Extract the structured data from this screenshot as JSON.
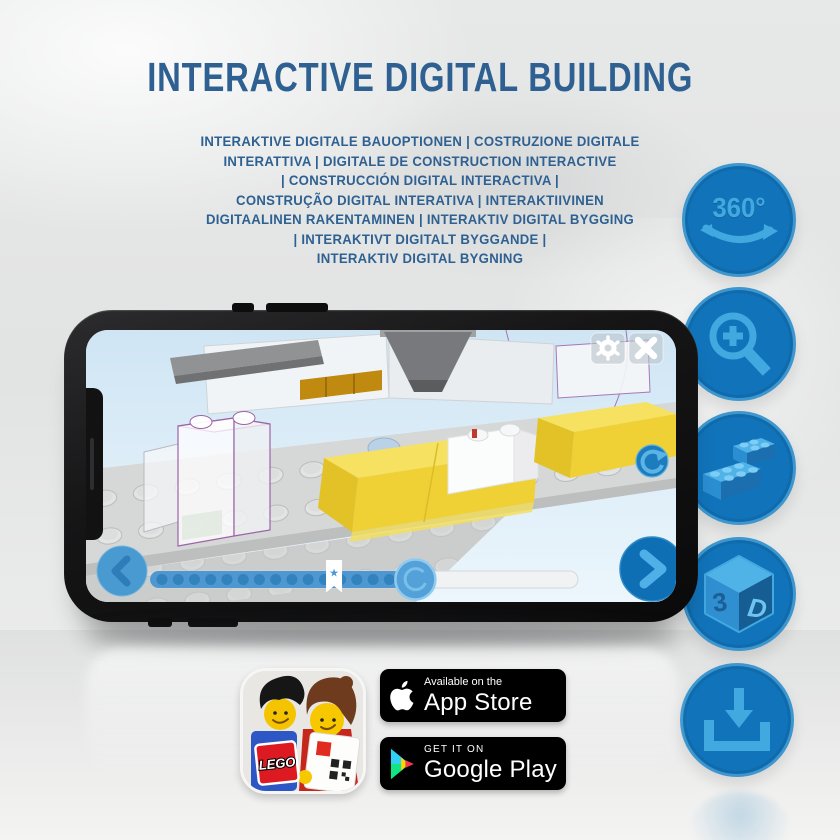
{
  "header": {
    "title": "INTERACTIVE DIGITAL BUILDING",
    "subtitle_lines": [
      "INTERAKTIVE DIGITALE BAUOPTIONEN | COSTRUZIONE DIGITALE",
      "INTERATTIVA | DIGITALE DE CONSTRUCTION INTERACTIVE",
      "| CONSTRUCCIÓN DIGITAL INTERACTIVA |",
      "CONSTRUÇÃO DIGITAL INTERATIVA | INTERAKTIIVINEN",
      "DIGITAALINEN RAKENTAMINEN | INTERAKTIV DIGITAL BYGGING",
      "| INTERAKTIVT DIGITALT BYGGANDE |",
      "INTERAKTIV DIGITAL BYGNING"
    ]
  },
  "feature_badges": [
    {
      "id": "rotate-360",
      "label": "360°"
    },
    {
      "id": "zoom-in"
    },
    {
      "id": "brick-building"
    },
    {
      "id": "3d-view",
      "face_left": "3",
      "face_right": "D"
    },
    {
      "id": "download"
    }
  ],
  "phone": {
    "progress": {
      "dot_count": 15,
      "star_position": 0.43,
      "handle_position": 0.62,
      "star_glyph": "★"
    }
  },
  "store": {
    "app_name": "LEGO",
    "app_store": {
      "tagline": "Available on the",
      "name": "App Store"
    },
    "google_play": {
      "tagline": "GET IT ON",
      "name": "Google Play"
    }
  },
  "colors": {
    "title_blue": "#2e6191",
    "badge_blue": "#1173b9",
    "badge_icon_blue": "#41a8e0",
    "screen_sky": "#d7eaf6",
    "brick_yellow": "#efd135",
    "ghost_outline_purple": "#9c63a8"
  }
}
